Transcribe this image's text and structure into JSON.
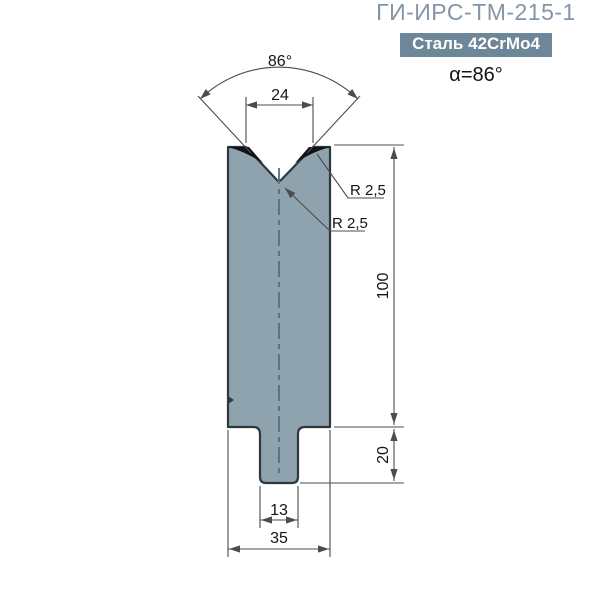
{
  "header": {
    "title": "ГИ-ИРС-ТМ-215-1",
    "material_badge": "Сталь 42CrMo4",
    "angle_label": "α=86°"
  },
  "dimensions": {
    "vee_angle": "86°",
    "vee_opening": "24",
    "shoulder_radius": "R 2,5",
    "tip_radius": "R 2,5",
    "die_height": "100",
    "base_height": "20",
    "tang_width": "13",
    "base_width": "35"
  },
  "colors": {
    "title-color": "#8495AA",
    "badge-bg": "#6E8798",
    "badge-text": "#FFFFFF",
    "ink": "#141414",
    "dim-line": "#4C4C4C",
    "body-fill": "#8FA3AE",
    "body-outline": "#2F383E",
    "corner-fill": "#101418",
    "centerline": "#4F7187"
  }
}
